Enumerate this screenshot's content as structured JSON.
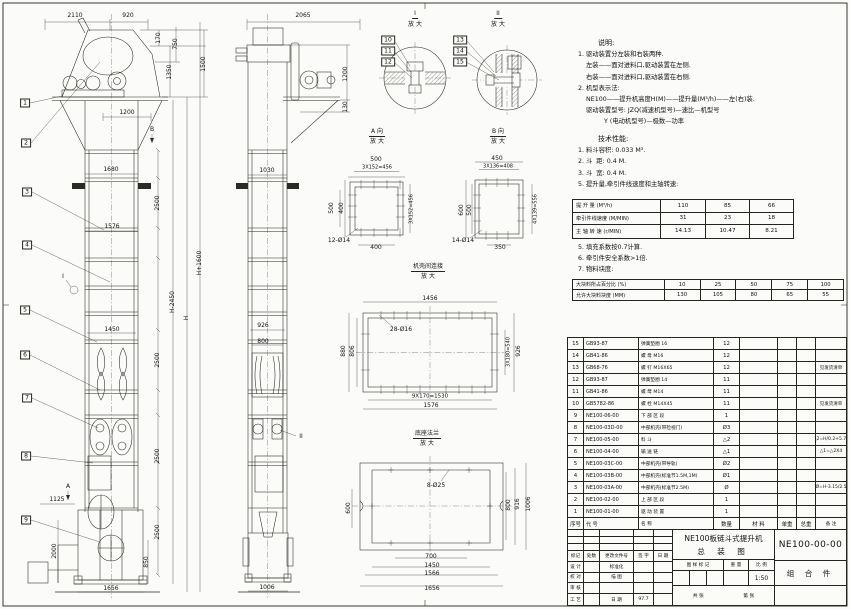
{
  "notes": {
    "title": "说明:",
    "lines": [
      "1. 驱动装置分左装和右装两种.",
      "    左装——面对进料口,驱动装置在左侧.",
      "    右装——面对进料口,驱动装置在右侧.",
      "2. 机型表示法:",
      "    NE100——提升机高度H(M)——提升量(M³/h)——左(右)装.",
      "    驱动装置型号: JZQ(减速机型号)—速比—机型号",
      "             Y (电动机型号)—极数—功率"
    ]
  },
  "tech": {
    "title": "技术性能:",
    "items_before": [
      "1. 料斗容积: 0.033 M³.",
      "2. 斗  距: 0.4 M.",
      "3. 斗  宽: 0.4 M.",
      "5. 提升量,牵引件线速度和主轴转速:"
    ],
    "speed_table": [
      [
        "提 升 量  (M³/h)",
        "110",
        "85",
        "66"
      ],
      [
        "牵引件线速度 (M/MIN)",
        "31",
        "23",
        "18"
      ],
      [
        "主 轴 转 速 (r/MIN)",
        "14.13",
        "10.47",
        "8.21"
      ]
    ],
    "items_after": [
      "5. 填充系数按0.7计算.",
      "6. 牵引件安全系数>1倍.",
      "7. 物料块度:"
    ],
    "lump_table": [
      [
        "大块料所占百分比 (%)",
        "10",
        "25",
        "50",
        "75",
        "100"
      ],
      [
        "允许大块料块度 (MM)",
        "130",
        "105",
        "80",
        "65",
        "55"
      ]
    ]
  },
  "bom": {
    "table": [
      [
        "15",
        "GB93-87",
        "弹簧垫圈 16",
        "12",
        "",
        "",
        "",
        ""
      ],
      [
        "14",
        "GB41-86",
        "螺  母  M16",
        "12",
        "",
        "",
        "",
        ""
      ],
      [
        "13",
        "GB68-76",
        "螺  钉  M16X65",
        "12",
        "",
        "",
        "",
        "见发货清单"
      ],
      [
        "12",
        "GB93-87",
        "弹簧垫圈 14",
        "11",
        "",
        "",
        "",
        ""
      ],
      [
        "11",
        "GB41-86",
        "螺  母  M14",
        "11",
        "",
        "",
        "",
        ""
      ],
      [
        "10",
        "GB5782-86",
        "螺  栓  M14X45",
        "11",
        "",
        "",
        "",
        "见发货清单"
      ],
      [
        "9",
        "NE100-06-00",
        "下 部 区 段",
        "1",
        "",
        "",
        "",
        ""
      ],
      [
        "8",
        "NE100-03D-00",
        "中部机壳(带检视门)",
        "Ø3",
        "",
        "",
        "",
        ""
      ],
      [
        "7",
        "NE100-05-00",
        "料  斗",
        "△2",
        "",
        "",
        "",
        "△2=H/0.2+5.75"
      ],
      [
        "6",
        "NE100-04-00",
        "输 送 链",
        "△1",
        "",
        "",
        "",
        "△1=△2X4"
      ],
      [
        "5",
        "NE100-03C-00",
        "中部机壳(带导轨)",
        "Ø2",
        "",
        "",
        "",
        ""
      ],
      [
        "4",
        "NE100-03B-00",
        "中部机壳(标准节1.5M,1M)",
        "Ø1",
        "",
        "",
        "",
        ""
      ],
      [
        "3",
        "NE100-03A-00",
        "中部机壳(标准节2.5M)",
        "Ø",
        "",
        "",
        "",
        "Ø=H-3.15/2.5"
      ],
      [
        "2",
        "NE100-02-00",
        "上 部 区 段",
        "1",
        "",
        "",
        "",
        ""
      ],
      [
        "1",
        "NE100-01-00",
        "驱 动 装 置",
        "1",
        "",
        "",
        "",
        ""
      ],
      [
        "序号",
        "代  号",
        "名  称",
        "数量",
        "材  料",
        "单重",
        "总重",
        "备 注"
      ]
    ]
  },
  "title_block": {
    "product": "NE100板链斗式提升机",
    "drawing_name": "总 装 图",
    "drawing_no": "NE100-00-00",
    "part_type": "组 合 件",
    "mark_label": "图 样 标 记",
    "weight_label": "重 量",
    "scale_label": "比 例",
    "scale": "1:50",
    "date": "97.7",
    "sheet_left": "共  张",
    "sheet_right": "第  张",
    "rev_rows": [
      [
        "标记",
        "处数",
        "更改文件号",
        "签 字",
        "日 期"
      ],
      [
        "设 计",
        "",
        "标准化",
        "",
        ""
      ],
      [
        "校 对",
        "",
        "描 图",
        "",
        ""
      ],
      [
        "审 核",
        "",
        "",
        "",
        ""
      ],
      [
        "工 艺",
        "",
        "日 期",
        "97.7",
        ""
      ]
    ]
  },
  "drawing": {
    "labels": [
      {
        "t": "2110",
        "x": 75,
        "y": 16
      },
      {
        "t": "920",
        "x": 128,
        "y": 16
      },
      {
        "t": "1",
        "x": 25,
        "y": 103,
        "b": 1
      },
      {
        "t": "2",
        "x": 26,
        "y": 143,
        "b": 1
      },
      {
        "t": "170",
        "x": 159,
        "y": 38,
        "r": 1
      },
      {
        "t": "750",
        "x": 176,
        "y": 44,
        "r": 1
      },
      {
        "t": "1350",
        "x": 170,
        "y": 72,
        "r": 1
      },
      {
        "t": "1500",
        "x": 204,
        "y": 64,
        "r": 1
      },
      {
        "t": "1200",
        "x": 127,
        "y": 113
      },
      {
        "t": "B",
        "x": 152,
        "y": 130
      },
      {
        "t": "1680",
        "x": 111,
        "y": 170
      },
      {
        "t": "2500",
        "x": 158,
        "y": 203,
        "r": 1
      },
      {
        "t": "3",
        "x": 27,
        "y": 192,
        "b": 1
      },
      {
        "t": "1576",
        "x": 112,
        "y": 227
      },
      {
        "t": "4",
        "x": 27,
        "y": 245,
        "b": 1
      },
      {
        "t": "I",
        "x": 63,
        "y": 277
      },
      {
        "t": "H+1600",
        "x": 200,
        "y": 263,
        "r": 1
      },
      {
        "t": "H-2450",
        "x": 173,
        "y": 302,
        "r": 1
      },
      {
        "t": "H",
        "x": 187,
        "y": 318,
        "r": 1
      },
      {
        "t": "5",
        "x": 25,
        "y": 310,
        "b": 1
      },
      {
        "t": "1450",
        "x": 112,
        "y": 330
      },
      {
        "t": "2500",
        "x": 158,
        "y": 360,
        "r": 1
      },
      {
        "t": "6",
        "x": 25,
        "y": 355,
        "b": 1
      },
      {
        "t": "7",
        "x": 27,
        "y": 398,
        "b": 1
      },
      {
        "t": "2500",
        "x": 158,
        "y": 456,
        "r": 1
      },
      {
        "t": "8",
        "x": 26,
        "y": 456,
        "b": 1
      },
      {
        "t": "A",
        "x": 68,
        "y": 487
      },
      {
        "t": "1125",
        "x": 57,
        "y": 500
      },
      {
        "t": "9",
        "x": 26,
        "y": 520,
        "b": 1
      },
      {
        "t": "2000",
        "x": 55,
        "y": 551,
        "r": 1
      },
      {
        "t": "2500",
        "x": 158,
        "y": 532,
        "r": 1
      },
      {
        "t": "850",
        "x": 147,
        "y": 562,
        "r": 1
      },
      {
        "t": "1656",
        "x": 111,
        "y": 589
      },
      {
        "t": "2065",
        "x": 303,
        "y": 16
      },
      {
        "t": "1200",
        "x": 346,
        "y": 74,
        "r": 1
      },
      {
        "t": "130",
        "x": 346,
        "y": 107,
        "r": 1
      },
      {
        "t": "1030",
        "x": 267,
        "y": 171
      },
      {
        "t": "926",
        "x": 263,
        "y": 326
      },
      {
        "t": "800",
        "x": 263,
        "y": 342
      },
      {
        "t": "II",
        "x": 301,
        "y": 437
      },
      {
        "t": "1006",
        "x": 267,
        "y": 588
      },
      {
        "t": "I",
        "x": 415,
        "y": 15,
        "u": 1
      },
      {
        "t": "放 大",
        "x": 415,
        "y": 25
      },
      {
        "t": "10",
        "x": 388,
        "y": 40,
        "b": 1
      },
      {
        "t": "11",
        "x": 388,
        "y": 51,
        "b": 1
      },
      {
        "t": "12",
        "x": 388,
        "y": 62,
        "b": 1
      },
      {
        "t": "II",
        "x": 498,
        "y": 15,
        "u": 1
      },
      {
        "t": "放 大",
        "x": 498,
        "y": 25
      },
      {
        "t": "13",
        "x": 460,
        "y": 40,
        "b": 1
      },
      {
        "t": "14",
        "x": 460,
        "y": 51,
        "b": 1
      },
      {
        "t": "15",
        "x": 460,
        "y": 62,
        "b": 1
      },
      {
        "t": "A 向",
        "x": 377,
        "y": 133,
        "u": 1
      },
      {
        "t": "放 大",
        "x": 377,
        "y": 142
      },
      {
        "t": "500",
        "x": 376,
        "y": 160
      },
      {
        "t": "3X152=456",
        "x": 377,
        "y": 168,
        "s": 5
      },
      {
        "t": "500",
        "x": 332,
        "y": 208,
        "r": 1
      },
      {
        "t": "400",
        "x": 342,
        "y": 208,
        "r": 1
      },
      {
        "t": "3X152=456",
        "x": 412,
        "y": 209,
        "r": 1,
        "s": 5
      },
      {
        "t": "12-Ø14",
        "x": 339,
        "y": 241
      },
      {
        "t": "400",
        "x": 376,
        "y": 248
      },
      {
        "t": "B 向",
        "x": 498,
        "y": 133,
        "u": 1
      },
      {
        "t": "放 大",
        "x": 498,
        "y": 142
      },
      {
        "t": "450",
        "x": 497,
        "y": 159
      },
      {
        "t": "3X136=408",
        "x": 498,
        "y": 167,
        "s": 5
      },
      {
        "t": "600",
        "x": 462,
        "y": 210,
        "r": 1
      },
      {
        "t": "500",
        "x": 470,
        "y": 210,
        "r": 1
      },
      {
        "t": "4X139=556",
        "x": 536,
        "y": 209,
        "r": 1,
        "s": 5
      },
      {
        "t": "14-Ø14",
        "x": 463,
        "y": 241
      },
      {
        "t": "350",
        "x": 500,
        "y": 248
      },
      {
        "t": "机壳间连接",
        "x": 428,
        "y": 268,
        "u": 1,
        "s": 6
      },
      {
        "t": "放 大",
        "x": 428,
        "y": 277
      },
      {
        "t": "1456",
        "x": 430,
        "y": 299
      },
      {
        "t": "28-Ø16",
        "x": 401,
        "y": 330
      },
      {
        "t": "880",
        "x": 344,
        "y": 351,
        "r": 1
      },
      {
        "t": "806",
        "x": 353,
        "y": 351,
        "r": 1
      },
      {
        "t": "3X180=540",
        "x": 509,
        "y": 352,
        "r": 1,
        "s": 5
      },
      {
        "t": "926",
        "x": 519,
        "y": 351,
        "r": 1
      },
      {
        "t": "9X170=1530",
        "x": 430,
        "y": 397,
        "s": 5.5
      },
      {
        "t": "1576",
        "x": 431,
        "y": 406
      },
      {
        "t": "底座法兰",
        "x": 427,
        "y": 435,
        "u": 1,
        "s": 6
      },
      {
        "t": "放 大",
        "x": 427,
        "y": 444
      },
      {
        "t": "8-Ø25",
        "x": 436,
        "y": 486
      },
      {
        "t": "600",
        "x": 349,
        "y": 508,
        "r": 1
      },
      {
        "t": "800",
        "x": 509,
        "y": 505,
        "r": 1
      },
      {
        "t": "916",
        "x": 518,
        "y": 504,
        "r": 1
      },
      {
        "t": "1006",
        "x": 529,
        "y": 504,
        "r": 1
      },
      {
        "t": "700",
        "x": 431,
        "y": 557
      },
      {
        "t": "1450",
        "x": 432,
        "y": 566
      },
      {
        "t": "1566",
        "x": 432,
        "y": 574
      },
      {
        "t": "1656",
        "x": 432,
        "y": 589
      }
    ]
  }
}
